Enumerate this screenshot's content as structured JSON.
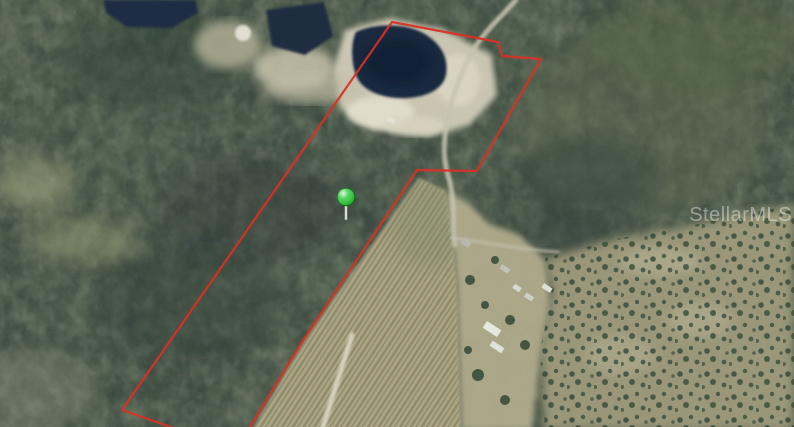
{
  "scene": "Aerial satellite photo of a wooded property with red parcel boundary outline, ponds, sandy clearing, crop rows, farmstead and a green location pin",
  "watermark": {
    "text": "StellarMLS",
    "color": "rgba(255,255,255,0.42)"
  },
  "colors": {
    "boundary_red": "#d93025",
    "pin_green": "#2bcb3a",
    "pin_stem": "#d9ddd6",
    "pond_navy": "#16263e",
    "sand": "#d6d0bc",
    "field_tan": "#b2aa89",
    "farmstead_tan": "#b5ae8f",
    "scrub_tan": "#a49f7f",
    "road_gray": "#cbc7b3",
    "lane_white": "#e3decb",
    "forest_base": "#4e5b4c"
  },
  "map": {
    "boundary": {
      "points": "392,22 498,42 502,56 541,59 477,171 417,170 302,342 247,432 200,437 122,410"
    },
    "pin": {
      "x": 346,
      "y": 197,
      "transform": "translate(346,197)"
    },
    "ponds": {
      "top_left": "103,0 196,0 198,13 172,28 127,27 106,13",
      "upper": "266,10 324,2 333,36 305,55 272,46",
      "main_d": "M356,32 C374,23 406,23 423,33 C441,43 449,58 446,75 C443,89 427,97 407,98 C387,99 367,93 359,81 C351,69 350,43 356,32 Z"
    },
    "sand_clearing": "333,70 345,30 390,18 445,30 492,55 497,95 470,125 430,136 372,130 340,108",
    "farm_field": "419,178 445,190 452,225 457,290 461,430 252,430 304,341",
    "farmstead": "445,190 470,205 490,225 520,235 545,260 550,300 540,360 532,430 461,430 457,290 452,225",
    "scrubland": "545,430 540,350 552,295 545,258 575,250 620,238 680,228 740,215 794,205 794,430",
    "roads": {
      "main_trail_d": "M516,0 C500,18 482,34 472,52 C461,73 450,100 446,128 C443,150 444,164 450,182 C455,205 452,225 455,245",
      "cross_path_d": "M452,238 C490,243 525,250 558,252",
      "field_lane_d": "M352,335 L322,430"
    }
  }
}
